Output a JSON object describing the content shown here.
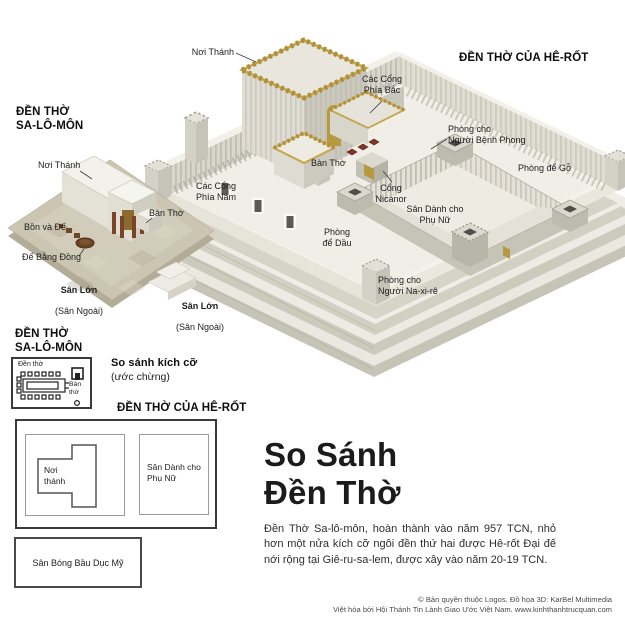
{
  "colors": {
    "background": "#ffffff",
    "stone_light": "#f0eee6",
    "stone_mid": "#d9d6cb",
    "stone_dark": "#c6c3b7",
    "gold_trim": "#ad8f3c",
    "bronze": "#6a4426",
    "text": "#1d1d1d"
  },
  "herod": {
    "heading": "ĐỀN THỜ CỦA HÊ-RỐT",
    "labels": {
      "noi_thanh": "Nơi Thánh",
      "cac_cong_phia_bac": "Các Cổng\nPhía Bắc",
      "phong_benh_phong": "Phòng cho\nNgười Bệnh Phong",
      "ban_tho": "Bàn Thờ",
      "phong_de_go": "Phòng để Gỗ",
      "cac_cong_phia_nam": "Các Cổng\nPhía Nam",
      "cong_nicanor": "Cổng\nNicanor",
      "san_phu_nu": "Sân Dành cho\nPhụ Nữ",
      "phong_de_dau": "Phòng\nđể Dầu",
      "phong_na_xi_re": "Phòng cho\nNgười Na-xi-rê"
    }
  },
  "solomon": {
    "heading": "ĐỀN THỜ\nSA-LÔ-MÔN",
    "labels": {
      "noi_thanh": "Nơi Thánh",
      "bon_va_de": "Bồn và Đế",
      "ban_tho": "Bàn Thờ",
      "de_bang_dong": "Đế Bằng Đồng",
      "san_lon": {
        "title": "Sân Lớn",
        "sub": "(Sân Ngoài)"
      },
      "san_lon_2": {
        "title": "Sân Lớn",
        "sub": "(Sân Ngoài)"
      }
    }
  },
  "comparison": {
    "solomon_heading": "ĐỀN THỜ\nSA-LÔ-MÔN",
    "size_title": "So sánh kích cỡ",
    "size_sub": "(ước chừng)",
    "herod_heading": "ĐỀN THỜ CỦA HÊ-RỐT",
    "solomon_plan": {
      "temple": "Đền thờ",
      "altar": "Bàn\nthờ"
    },
    "herod_plan": {
      "sanctuary": "Nơi\nthánh",
      "women": "Sân Dành cho\nPhụ Nữ"
    },
    "football": "Sân Bóng Bầu Dục Mỹ"
  },
  "info": {
    "title": "So Sánh\nĐền Thờ",
    "description": "Đền Thờ Sa-lô-môn, hoàn thành vào năm 957 TCN, nhỏ hơn một nửa kích cỡ ngôi đền thứ hai được Hê-rốt Đại đế nới rộng tại Giê-ru-sa-lem, được xây vào năm 20-19 TCN."
  },
  "credits": {
    "line1": "© Bản quyền thuộc Logos. Đồ họa 3D: KarBel Multimedia",
    "line2": "Việt hóa bởi Hội Thánh Tin Lành Giao Ước Việt Nam. www.kinhthanhtrucquan.com"
  }
}
